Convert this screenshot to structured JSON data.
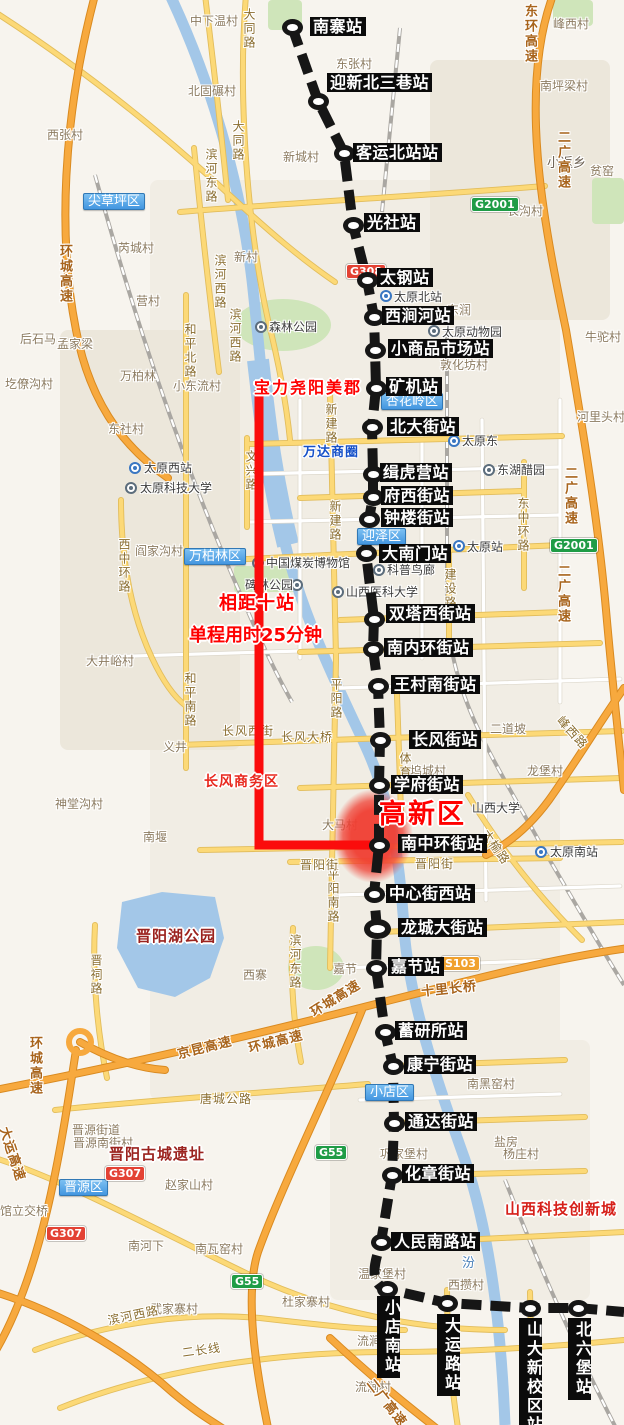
{
  "colors": {
    "metro_line": "#161616",
    "route_highlight": "#fb0c0c",
    "zone_fill": "#f0453c",
    "district_blue": "#4396e0",
    "shield_green": "#1f9c46",
    "shield_red": "#e34234",
    "shield_orange": "#f0a12e"
  },
  "stations": [
    {
      "name": "南寨站",
      "x": 292,
      "y": 27,
      "lx": 310,
      "ly": 17
    },
    {
      "name": "迎新北三巷站",
      "x": 318,
      "y": 101,
      "lx": 327,
      "ly": 73
    },
    {
      "name": "客运北站站",
      "x": 344,
      "y": 153,
      "lx": 353,
      "ly": 143
    },
    {
      "name": "光社站",
      "x": 353,
      "y": 225,
      "lx": 364,
      "ly": 213
    },
    {
      "name": "太钢站",
      "x": 367,
      "y": 280,
      "lx": 377,
      "ly": 268
    },
    {
      "name": "西涧河站",
      "x": 374,
      "y": 317,
      "lx": 382,
      "ly": 306
    },
    {
      "name": "小商品市场站",
      "x": 375,
      "y": 350,
      "lx": 388,
      "ly": 339
    },
    {
      "name": "矿机站",
      "x": 376,
      "y": 388,
      "lx": 386,
      "ly": 377
    },
    {
      "name": "北大街站",
      "x": 372,
      "y": 427,
      "lx": 387,
      "ly": 417
    },
    {
      "name": "缉虎营站",
      "x": 373,
      "y": 474,
      "lx": 380,
      "ly": 463
    },
    {
      "name": "府西街站",
      "x": 373,
      "y": 497,
      "lx": 381,
      "ly": 486
    },
    {
      "name": "钟楼街站",
      "x": 369,
      "y": 519,
      "lx": 381,
      "ly": 508
    },
    {
      "name": "大南门站",
      "x": 366,
      "y": 553,
      "lx": 379,
      "ly": 544
    },
    {
      "name": "双塔西街站",
      "x": 374,
      "y": 619,
      "lx": 386,
      "ly": 604
    },
    {
      "name": "南内环街站",
      "x": 373,
      "y": 649,
      "lx": 384,
      "ly": 638
    },
    {
      "name": "王村南街站",
      "x": 378,
      "y": 686,
      "lx": 391,
      "ly": 675
    },
    {
      "name": "长风街站",
      "x": 380,
      "y": 740,
      "lx": 409,
      "ly": 730
    },
    {
      "name": "学府街站",
      "x": 379,
      "y": 785,
      "lx": 391,
      "ly": 775
    },
    {
      "name": "南中环街站",
      "x": 379,
      "y": 845,
      "lx": 398,
      "ly": 834
    },
    {
      "name": "中心街西站",
      "x": 374,
      "y": 894,
      "lx": 386,
      "ly": 884
    },
    {
      "name": "龙城大街站",
      "x": 377,
      "y": 929,
      "lx": 398,
      "ly": 918,
      "big": true
    },
    {
      "name": "嘉节站",
      "x": 376,
      "y": 968,
      "lx": 388,
      "ly": 957
    },
    {
      "name": "蓄研所站",
      "x": 385,
      "y": 1032,
      "lx": 395,
      "ly": 1021
    },
    {
      "name": "康宁街站",
      "x": 393,
      "y": 1066,
      "lx": 404,
      "ly": 1055
    },
    {
      "name": "通达街站",
      "x": 394,
      "y": 1123,
      "lx": 405,
      "ly": 1112
    },
    {
      "name": "化章街站",
      "x": 392,
      "y": 1175,
      "lx": 402,
      "ly": 1164
    },
    {
      "name": "人民南路站",
      "x": 381,
      "y": 1242,
      "lx": 391,
      "ly": 1232
    },
    {
      "name": "小店南站",
      "x": 387,
      "y": 1289,
      "lx": 377,
      "ly": 1296,
      "v": true
    },
    {
      "name": "大运路站",
      "x": 447,
      "y": 1303,
      "lx": 437,
      "ly": 1314,
      "v": true
    },
    {
      "name": "山大新校区站",
      "x": 530,
      "y": 1308,
      "lx": 519,
      "ly": 1318,
      "v": true
    },
    {
      "name": "北六堡站",
      "x": 578,
      "y": 1308,
      "lx": 568,
      "ly": 1318,
      "v": true
    }
  ],
  "annotations": [
    {
      "id": "estate",
      "text": "宝力尧阳美郡",
      "x": 254,
      "y": 374,
      "size": 16,
      "color": "#ff0000",
      "ls": 2
    },
    {
      "id": "stations-apart",
      "text": "相距十站",
      "x": 219,
      "y": 589,
      "size": 18,
      "color": "#ff0000",
      "ls": 1
    },
    {
      "id": "trip-time",
      "text": "单程用时25分钟",
      "x": 189,
      "y": 621,
      "size": 18,
      "color": "#ff0000",
      "ls": 0
    },
    {
      "id": "hi-tech-zone",
      "text": "高新区",
      "x": 379,
      "y": 792,
      "size": 27,
      "color": "#ff0000",
      "ls": 2,
      "w": 900
    },
    {
      "id": "changfeng-business",
      "text": "长风商务区",
      "x": 204,
      "y": 771,
      "size": 14,
      "color": "#e8281e",
      "ls": 1
    },
    {
      "id": "jinyang-lake-park",
      "text": "晋阳湖公园",
      "x": 136,
      "y": 925,
      "size": 15,
      "color": "#9b231f",
      "ls": 1
    },
    {
      "id": "jinyang-ruins",
      "text": "晋阳古城遗址",
      "x": 109,
      "y": 1143,
      "size": 15,
      "color": "#9b231f",
      "ls": 1
    },
    {
      "id": "sci-tech-city",
      "text": "山西科技创新城",
      "x": 505,
      "y": 1198,
      "size": 15,
      "color": "#d6201a",
      "ls": 1
    }
  ],
  "business_circle": {
    "text": "万达商圈",
    "x": 303,
    "y": 441
  },
  "districts": [
    {
      "name": "尖草坪区",
      "x": 83,
      "y": 193
    },
    {
      "name": "杏花岭区",
      "x": 381,
      "y": 393
    },
    {
      "name": "迎泽区",
      "x": 357,
      "y": 528
    },
    {
      "name": "万柏林区",
      "x": 184,
      "y": 548
    },
    {
      "name": "小店区",
      "x": 365,
      "y": 1084
    },
    {
      "name": "晋源区",
      "x": 59,
      "y": 1179
    }
  ],
  "shields": [
    {
      "t": "G2001",
      "c": "g",
      "x": 471,
      "y": 197
    },
    {
      "t": "G308",
      "c": "r",
      "x": 346,
      "y": 264
    },
    {
      "t": "G2001",
      "c": "g",
      "x": 550,
      "y": 538
    },
    {
      "t": "S103",
      "c": "s",
      "x": 441,
      "y": 956
    },
    {
      "t": "G55",
      "c": "g",
      "x": 315,
      "y": 1145
    },
    {
      "t": "G307",
      "c": "r",
      "x": 105,
      "y": 1166
    },
    {
      "t": "G307",
      "c": "r",
      "x": 46,
      "y": 1226
    },
    {
      "t": "G55",
      "c": "g",
      "x": 231,
      "y": 1274
    }
  ],
  "pois": [
    {
      "name": "森林公园",
      "icon": "sight",
      "ix": 255,
      "iy": 321,
      "tx": 269,
      "ty": 318
    },
    {
      "name": "太原北站",
      "icon": "metro",
      "ix": 380,
      "iy": 290,
      "tx": 394,
      "ty": 288
    },
    {
      "name": "太原动物园",
      "icon": "sight",
      "ix": 428,
      "iy": 325,
      "tx": 442,
      "ty": 323
    },
    {
      "name": "太原东",
      "icon": "metro",
      "ix": 448,
      "iy": 435,
      "tx": 462,
      "ty": 432
    },
    {
      "name": "东湖醋园",
      "icon": "sight",
      "ix": 483,
      "iy": 464,
      "tx": 497,
      "ty": 461
    },
    {
      "name": "太原站",
      "icon": "metro",
      "ix": 453,
      "iy": 540,
      "tx": 467,
      "ty": 538
    },
    {
      "name": "太原西站",
      "icon": "metro",
      "ix": 129,
      "iy": 462,
      "tx": 144,
      "ty": 459
    },
    {
      "name": "太原科技大学",
      "icon": "sight",
      "ix": 125,
      "iy": 482,
      "tx": 140,
      "ty": 479
    },
    {
      "name": "中国煤炭博物馆",
      "icon": "sight",
      "ix": 252,
      "iy": 557,
      "tx": 266,
      "ty": 554
    },
    {
      "name": "碑林公园",
      "icon": "sight",
      "ix": 291,
      "iy": 579,
      "tx": 245,
      "ty": 576
    },
    {
      "name": "科普鸟廊",
      "icon": "sight",
      "ix": 373,
      "iy": 564,
      "tx": 387,
      "ty": 561
    },
    {
      "name": "山西医科大学",
      "icon": "sight",
      "ix": 332,
      "iy": 586,
      "tx": 346,
      "ty": 583
    },
    {
      "name": "山西大学",
      "tx": 472,
      "ty": 799
    },
    {
      "name": "太原南站",
      "icon": "metro",
      "ix": 535,
      "iy": 846,
      "tx": 550,
      "ty": 843
    }
  ],
  "roads": [
    {
      "t": "大同路",
      "x": 241,
      "y": 8,
      "v": 1
    },
    {
      "t": "大同路",
      "x": 230,
      "y": 120,
      "v": 1
    },
    {
      "t": "滨河东路",
      "x": 203,
      "y": 148,
      "v": 1
    },
    {
      "t": "滨河西路",
      "x": 212,
      "y": 254,
      "v": 1
    },
    {
      "t": "滨河西路",
      "x": 227,
      "y": 308,
      "v": 1
    },
    {
      "t": "和平北路",
      "x": 182,
      "y": 323,
      "v": 1
    },
    {
      "t": "和平南路",
      "x": 182,
      "y": 672,
      "v": 1
    },
    {
      "t": "西中环路",
      "x": 116,
      "y": 538,
      "v": 1
    },
    {
      "t": "文兴路",
      "x": 243,
      "y": 450,
      "v": 1
    },
    {
      "t": "新建路",
      "x": 323,
      "y": 403,
      "v": 1
    },
    {
      "t": "新建路",
      "x": 327,
      "y": 500,
      "v": 1
    },
    {
      "t": "平阳路",
      "x": 328,
      "y": 678,
      "v": 1
    },
    {
      "t": "体育路",
      "x": 397,
      "y": 752,
      "v": 1
    },
    {
      "t": "平阳南路",
      "x": 325,
      "y": 868,
      "v": 1
    },
    {
      "t": "滨河东路",
      "x": 287,
      "y": 934,
      "v": 1
    },
    {
      "t": "晋祠路",
      "x": 88,
      "y": 954,
      "v": 1
    },
    {
      "t": "东中环路",
      "x": 515,
      "y": 497,
      "v": 1
    },
    {
      "t": "建设路",
      "x": 442,
      "y": 568,
      "v": 1
    },
    {
      "t": "长风西街",
      "x": 222,
      "y": 722
    },
    {
      "t": "长风大桥",
      "x": 281,
      "y": 728
    },
    {
      "t": "晋阳街",
      "x": 300,
      "y": 856
    },
    {
      "t": "晋阳街",
      "x": 415,
      "y": 855
    },
    {
      "t": "唐城公路",
      "x": 200,
      "y": 1090
    },
    {
      "t": "滨河西路",
      "x": 106,
      "y": 1312,
      "rot": -12
    },
    {
      "t": "二长线",
      "x": 181,
      "y": 1344,
      "rot": -8
    },
    {
      "t": "太榆路",
      "x": 492,
      "y": 826,
      "rot": 55
    },
    {
      "t": "峰西路",
      "x": 566,
      "y": 712,
      "rot": 48
    },
    {
      "t": "十里长桥",
      "x": 420,
      "y": 981,
      "rot": -6,
      "hw": 1
    },
    {
      "t": "环城高速",
      "x": 55,
      "y": 244,
      "v": 1,
      "hw": 1
    },
    {
      "t": "环城高速",
      "x": 25,
      "y": 1036,
      "v": 1,
      "hw": 1
    },
    {
      "t": "京昆高速",
      "x": 175,
      "y": 1044,
      "rot": -14,
      "hw": 1
    },
    {
      "t": "环城高速",
      "x": 246,
      "y": 1038,
      "rot": -14,
      "hw": 1
    },
    {
      "t": "环城高速",
      "x": 306,
      "y": 1004,
      "rot": -32,
      "hw": 1
    },
    {
      "t": "大运高速",
      "x": 14,
      "y": 1124,
      "rot": 72,
      "hw": 1
    },
    {
      "t": "东环高速",
      "x": 520,
      "y": 4,
      "v": 1,
      "hw": 1
    },
    {
      "t": "二广高速",
      "x": 553,
      "y": 130,
      "v": 1,
      "hw": 1
    },
    {
      "t": "二广高速",
      "x": 560,
      "y": 466,
      "v": 1,
      "hw": 1
    },
    {
      "t": "二广高速",
      "x": 553,
      "y": 564,
      "v": 1,
      "hw": 1
    },
    {
      "t": "二广高速",
      "x": 378,
      "y": 1374,
      "rot": 52,
      "hw": 1
    },
    {
      "t": "汾",
      "x": 462,
      "y": 1252,
      "river": 1
    }
  ],
  "places": [
    {
      "t": "中下温村",
      "x": 190,
      "y": 12
    },
    {
      "t": "北固碾村",
      "x": 188,
      "y": 82
    },
    {
      "t": "西张村",
      "x": 47,
      "y": 126
    },
    {
      "t": "东张村",
      "x": 336,
      "y": 55
    },
    {
      "t": "新城村",
      "x": 283,
      "y": 148
    },
    {
      "t": "峰西村",
      "x": 553,
      "y": 15
    },
    {
      "t": "南坪梁村",
      "x": 540,
      "y": 77
    },
    {
      "t": "小返乡",
      "x": 547,
      "y": 152,
      "cls": "town"
    },
    {
      "t": "贫窑",
      "x": 590,
      "y": 162
    },
    {
      "t": "长沟村",
      "x": 507,
      "y": 202
    },
    {
      "t": "新村",
      "x": 234,
      "y": 248
    },
    {
      "t": "芮城村",
      "x": 118,
      "y": 239
    },
    {
      "t": "营村",
      "x": 136,
      "y": 292
    },
    {
      "t": "东润",
      "x": 447,
      "y": 301
    },
    {
      "t": "后石马",
      "x": 20,
      "y": 330
    },
    {
      "t": "孟家梁",
      "x": 57,
      "y": 335
    },
    {
      "t": "牛驼村",
      "x": 585,
      "y": 328
    },
    {
      "t": "敦化坊村",
      "x": 440,
      "y": 356
    },
    {
      "t": "万柏林",
      "x": 120,
      "y": 367
    },
    {
      "t": "小东流村",
      "x": 173,
      "y": 377
    },
    {
      "t": "圪僚沟村",
      "x": 5,
      "y": 375
    },
    {
      "t": "河里头村",
      "x": 577,
      "y": 408
    },
    {
      "t": "东社村",
      "x": 108,
      "y": 420
    },
    {
      "t": "阎家沟村",
      "x": 135,
      "y": 542
    },
    {
      "t": "大井峪村",
      "x": 86,
      "y": 652
    },
    {
      "t": "义井",
      "x": 163,
      "y": 738
    },
    {
      "t": "二道坡",
      "x": 490,
      "y": 720
    },
    {
      "t": "龙堡村",
      "x": 527,
      "y": 762
    },
    {
      "t": "坞城村",
      "x": 410,
      "y": 762
    },
    {
      "t": "神堂沟村",
      "x": 55,
      "y": 795
    },
    {
      "t": "大马村",
      "x": 322,
      "y": 816
    },
    {
      "t": "南堰",
      "x": 143,
      "y": 828
    },
    {
      "t": "嘉节",
      "x": 333,
      "y": 960
    },
    {
      "t": "西寨",
      "x": 243,
      "y": 966
    },
    {
      "t": "南黑窑村",
      "x": 467,
      "y": 1075
    },
    {
      "t": "晋源街道",
      "x": 72,
      "y": 1121
    },
    {
      "t": "晋源南街村",
      "x": 73,
      "y": 1134
    },
    {
      "t": "盐房",
      "x": 494,
      "y": 1133
    },
    {
      "t": "杨庄村",
      "x": 503,
      "y": 1145
    },
    {
      "t": "巩家堡村",
      "x": 380,
      "y": 1145
    },
    {
      "t": "赵家山村",
      "x": 165,
      "y": 1176
    },
    {
      "t": "馆立交桥",
      "x": 0,
      "y": 1202
    },
    {
      "t": "南河下",
      "x": 128,
      "y": 1237
    },
    {
      "t": "南瓦窑村",
      "x": 195,
      "y": 1240
    },
    {
      "t": "温家堡村",
      "x": 358,
      "y": 1265
    },
    {
      "t": "西攒村",
      "x": 448,
      "y": 1276
    },
    {
      "t": "杜家寨村",
      "x": 282,
      "y": 1293
    },
    {
      "t": "武家寨村",
      "x": 150,
      "y": 1300
    },
    {
      "t": "流涧",
      "x": 357,
      "y": 1332
    },
    {
      "t": "流涧村",
      "x": 355,
      "y": 1378
    }
  ]
}
